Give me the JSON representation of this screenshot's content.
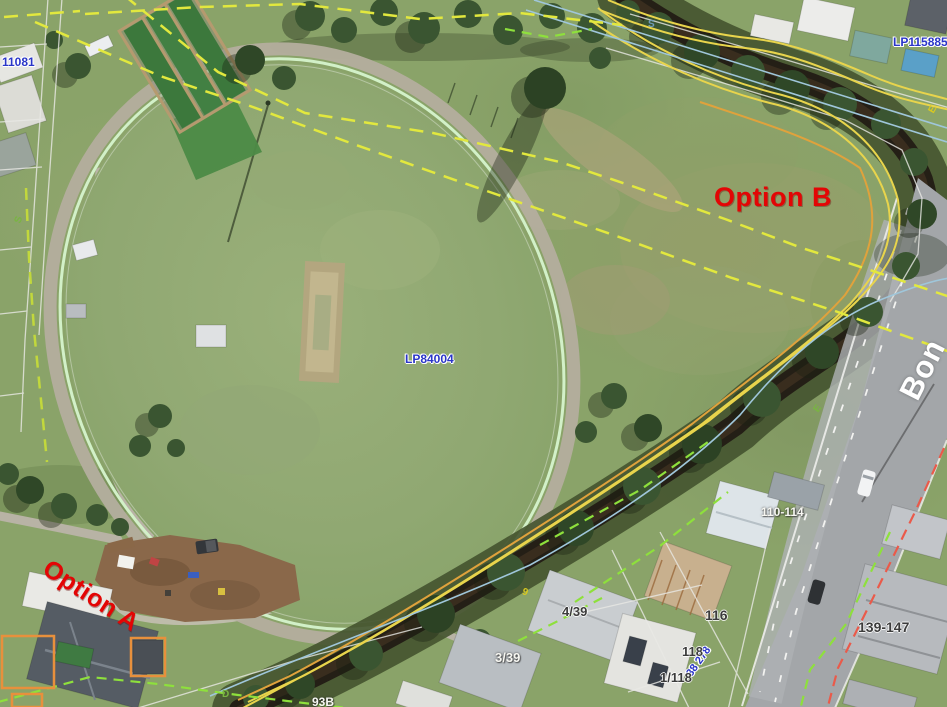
{
  "palette": {
    "option_red": "#e30505",
    "parcel_blue": "#2a35c8",
    "boundary_dashed_yellow": "#e2e83e",
    "boundary_dashed_green": "#8ee03c",
    "contour_yellow": "#e8d44c",
    "contour_orange": "#e0a23c",
    "watercourse_blue": "#9fc6da",
    "road_reserve_red": "#ea5a4a"
  },
  "plan_labels": {
    "parcel_top_left": "11081",
    "plan_top_right": "LP115885",
    "plan_center": "LP84004",
    "plan_bottom_rotated": "38 278"
  },
  "options": {
    "a": "Option A",
    "b": "Option B"
  },
  "road": {
    "name_fragment": "Bon"
  },
  "street_numbers": {
    "n110_114": "110-114",
    "n116": "116",
    "n118": "118",
    "n1_118": "1/118",
    "n4_39": "4/39",
    "n3_39": "3/39",
    "n139_147": "139-147",
    "n93b": "93B"
  },
  "survey_letters": {
    "s_top": "S",
    "s_left": "S",
    "e_yellow": "E",
    "e_green": "E",
    "d_bottom": "D",
    "nine": "9"
  }
}
